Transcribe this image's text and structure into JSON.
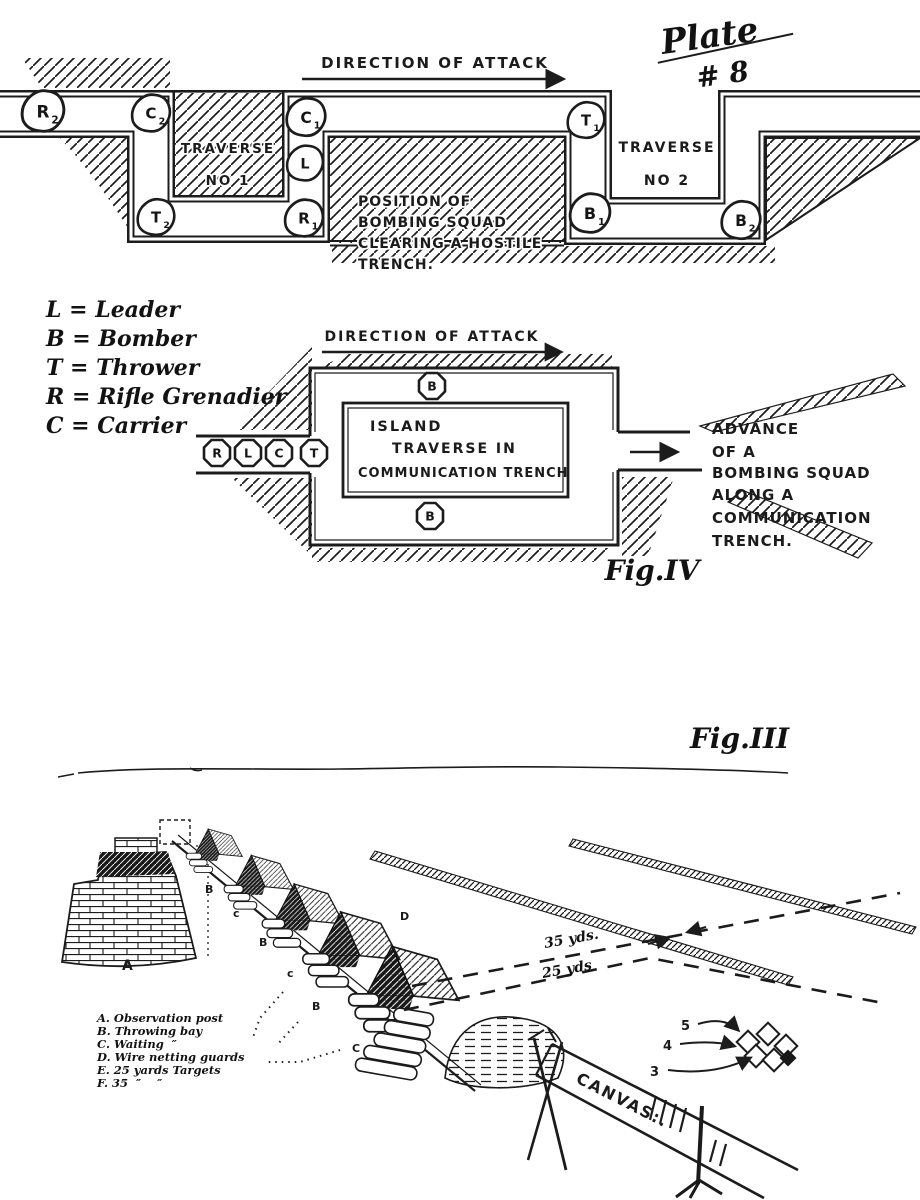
{
  "plate": {
    "line1": "Plate",
    "line2": "# 8"
  },
  "fig_top": {
    "direction_of_attack": "DIRECTION OF ATTACK",
    "traverse1_line1": "TRAVERSE",
    "traverse1_line2": "NO 1",
    "traverse2_line1": "TRAVERSE",
    "traverse2_line2": "NO 2",
    "note_line1": "POSITION OF",
    "note_line2": "BOMBING SQUAD",
    "note_line3": "CLEARING A HOSTILE",
    "note_line4": "TRENCH.",
    "markers": [
      {
        "label": "R",
        "sub": "2"
      },
      {
        "label": "C",
        "sub": "2"
      },
      {
        "label": "T",
        "sub": "2"
      },
      {
        "label": "C",
        "sub": "1"
      },
      {
        "label": "L",
        "sub": ""
      },
      {
        "label": "R",
        "sub": "1"
      },
      {
        "label": "T",
        "sub": "1"
      },
      {
        "label": "B",
        "sub": "1"
      },
      {
        "label": "B",
        "sub": "2"
      }
    ]
  },
  "key": {
    "items": [
      "L = Leader",
      "B = Bomber",
      "T = Thrower",
      "R = Rifle Grenadier",
      "C = Carrier"
    ]
  },
  "fig4": {
    "direction_of_attack": "DIRECTION OF ATTACK",
    "island_line1": "ISLAND",
    "island_line2": "TRAVERSE IN",
    "island_line3": "COMMUNICATION TRENCH",
    "bomber_top": "B",
    "bomber_bottom": "B",
    "squad": [
      "R",
      "L",
      "C",
      "T"
    ],
    "advance_line1": "ADVANCE",
    "advance_line2": "OF A",
    "advance_line3": "BOMBING SQUAD",
    "advance_line4": "ALONG A",
    "advance_line5": "COMMUNICATION",
    "advance_line6": "TRENCH.",
    "caption": "Fig.IV"
  },
  "fig3": {
    "caption": "Fig.III",
    "distance_35": "35 yds.",
    "distance_25": "25 yds",
    "canvas_label": "CANVAS:.",
    "target_numbers": [
      "5",
      "4",
      "3"
    ],
    "bay_letters": [
      "B",
      "c",
      "B",
      "c",
      "B",
      "C"
    ],
    "post_letter": "A",
    "wire_letter": "D",
    "legend": [
      "A. Observation post",
      "B. Throwing bay",
      "C. Waiting  ″",
      "D. Wire netting guards",
      "E. 25 yards Targets",
      "F. 35  ″    ″"
    ]
  },
  "colors": {
    "ink": "#1c1c1c",
    "paper": "#ffffff"
  }
}
